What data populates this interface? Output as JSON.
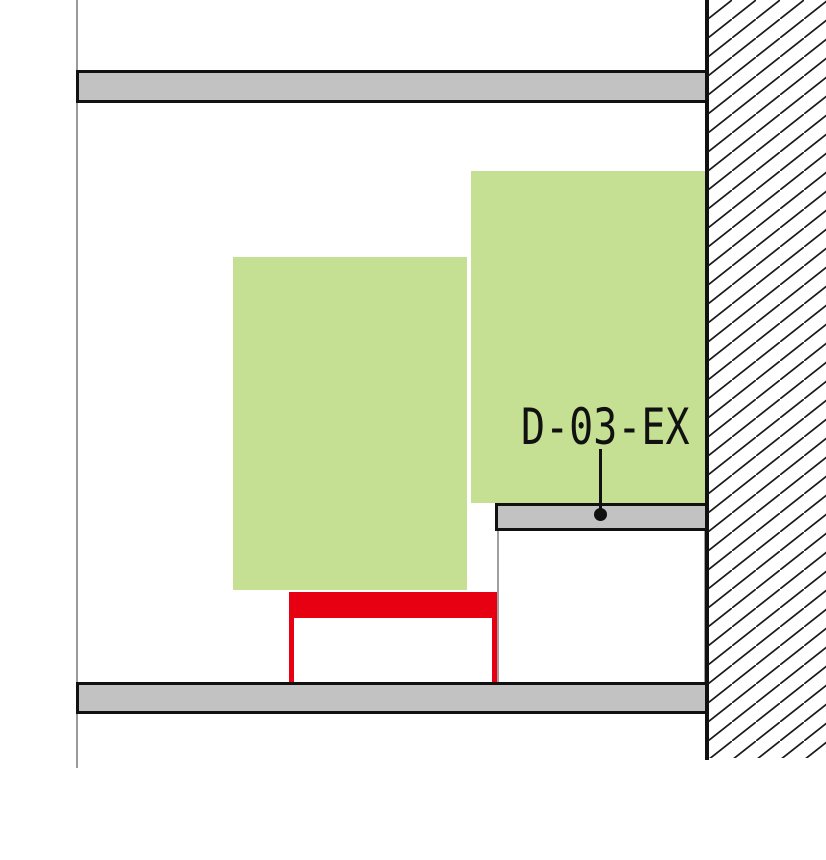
{
  "drawing": {
    "label": {
      "text": "D-03-EX"
    }
  },
  "palette": {
    "background": "#ffffff",
    "panel-green": "#c5e092",
    "rail-gray": "#c2c2c2",
    "accent-red": "#e60012",
    "line-black": "#111111",
    "thin-gray": "#9a9a9a",
    "box-border-gray": "#a0a0a0",
    "hatch-stroke": "#1a1a1a"
  }
}
